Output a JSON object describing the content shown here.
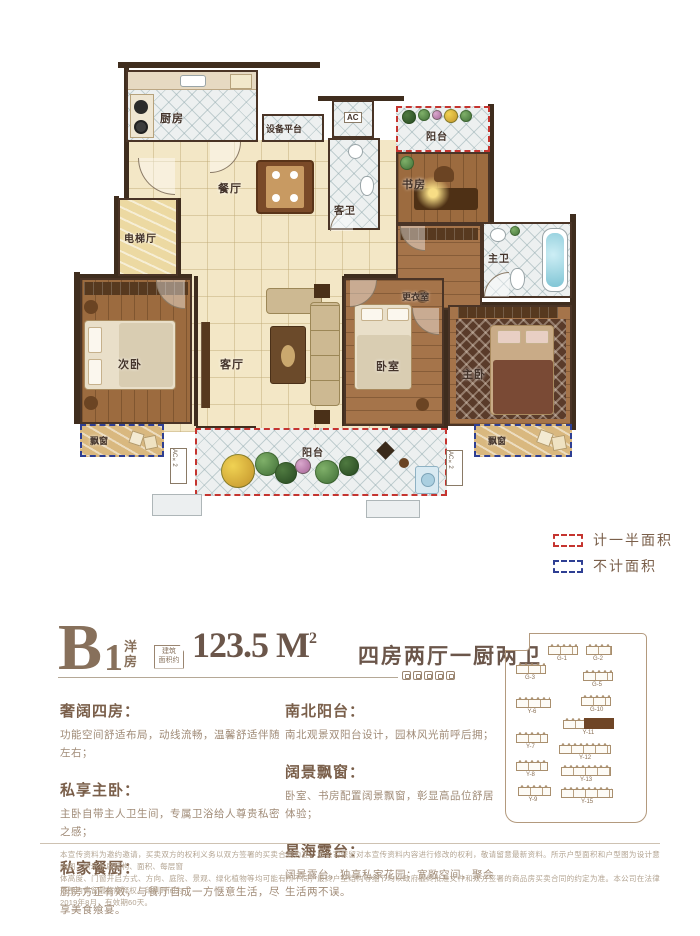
{
  "plan": {
    "labels": {
      "kitchen": "厨房",
      "equipment": "设备平台",
      "ac": "AC",
      "balcony_top": "阳台",
      "dining": "餐厅",
      "guest_bath": "客卫",
      "study": "书房",
      "elevator": "电梯厅",
      "master_bath": "主卫",
      "dressing": "更衣室",
      "bedroom2": "次卧",
      "living": "客厅",
      "bedroom3": "卧室",
      "master": "主卧",
      "bay_left": "飘窗",
      "bay_right": "飘窗",
      "balcony_bottom": "阳台",
      "ac2": "AC×2"
    }
  },
  "legend": [
    {
      "label": "计一半面积",
      "color": "#c5342f"
    },
    {
      "label": "不计面积",
      "color": "#2e3f93"
    }
  ],
  "title": {
    "letter": "B",
    "number": "1",
    "type": "洋房",
    "badge_line1": "建筑",
    "badge_line2": "面积约",
    "area_value": "123.5 M",
    "area_sup": "2",
    "rooms_desc": "四房两厅一厨两卫"
  },
  "features": {
    "left": [
      {
        "heading": "奢阔四房：",
        "body": "功能空间舒适布局，动线流畅，温馨舒适伴随左右；"
      },
      {
        "heading": "私享主卧：",
        "body": "主卧自带主人卫生间，专属卫浴给人尊贵私密之感；"
      },
      {
        "heading": "私家餐厨：",
        "body": "厨房方正有效，与餐厅自成一方惬意生活，尽享美食飨宴。"
      }
    ],
    "right": [
      {
        "heading": "南北阳台：",
        "body": "南北观景双阳台设计，园林风光前呼后拥；"
      },
      {
        "heading": "阔景飘窗：",
        "body": "卧室、书房配置阔景飘窗，彰显高品位舒居体验；"
      },
      {
        "heading": "星海露台：",
        "body": "阔景露台，独享私家花园；宽敞空间，聚会生活两不误。"
      }
    ]
  },
  "siteplan": {
    "highlighted_building": "Y-11",
    "buildings": [
      {
        "label": "G-1",
        "x": 42,
        "y": 12,
        "w": 30
      },
      {
        "label": "G-2",
        "x": 80,
        "y": 12,
        "w": 26
      },
      {
        "label": "G-3",
        "x": 10,
        "y": 31,
        "w": 30
      },
      {
        "label": "G-5",
        "x": 77,
        "y": 38,
        "w": 30
      },
      {
        "label": "Y-6",
        "x": 10,
        "y": 65,
        "w": 35
      },
      {
        "label": "G-10",
        "x": 75,
        "y": 63,
        "w": 30
      },
      {
        "label": "Y-11",
        "x": 57,
        "y": 86,
        "w": 51,
        "highlight": true
      },
      {
        "label": "Y-7",
        "x": 10,
        "y": 100,
        "w": 32
      },
      {
        "label": "Y-12",
        "x": 53,
        "y": 111,
        "w": 52
      },
      {
        "label": "Y-8",
        "x": 10,
        "y": 128,
        "w": 32
      },
      {
        "label": "Y-13",
        "x": 55,
        "y": 133,
        "w": 50
      },
      {
        "label": "Y-9",
        "x": 12,
        "y": 153,
        "w": 33
      },
      {
        "label": "Y-15",
        "x": 55,
        "y": 155,
        "w": 52
      }
    ]
  },
  "disclaimer": [
    "本宣传资料为邀约邀请，买卖双方的权利义务以双方签署的买卖合同为准。本公司保留对本宣传资料内容进行修改的权利，敬请留意最新资料。所示户型面积和户型图为设计意向图，所示布局结构、面积、每层窗",
    "体高度、门窗开启方式、方向、庭院、景观、绿化植物等均可能有所不同；最终户型结构等细节均以政府最终批准文件和双方签署的商品房买卖合同的约定为准。本公司在法律范围内保留最终解释权。印刷时间为",
    "2019年8月，有效期60天。"
  ],
  "colors": {
    "dash_half_area": "#c5342f",
    "dash_no_area": "#2e3f93",
    "brand_brown": "#7a5f4a",
    "wall": "#3f2d1e"
  }
}
